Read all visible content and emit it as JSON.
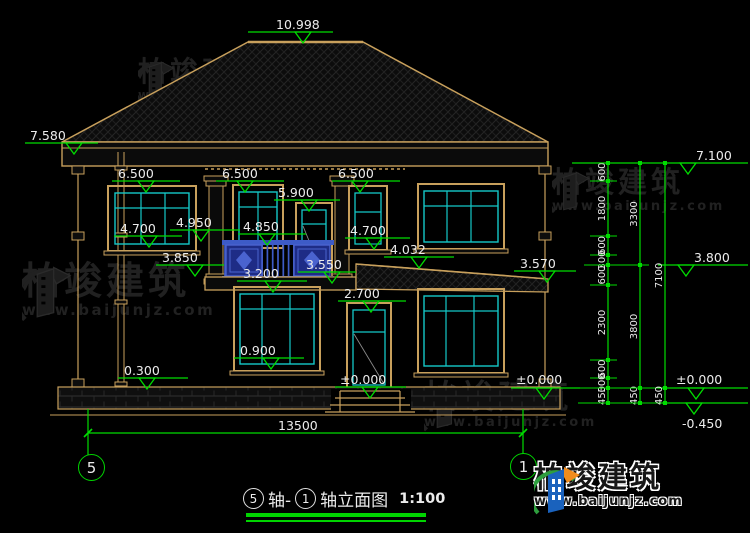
{
  "colors": {
    "tan": "#c8a05c",
    "cyan": "#14c8c8",
    "green": "#00dc00",
    "blue": "#3d5bc7",
    "panel_blue": "#1e2c86",
    "white": "#ececec",
    "watermark": "#212121"
  },
  "title": {
    "axis_start": "5",
    "mid": "轴- ",
    "axis_end": "1",
    "suffix": "轴立面图",
    "scale": "1:100"
  },
  "grid_bubbles": [
    {
      "label": "5"
    },
    {
      "label": "1"
    }
  ],
  "bottom_dim": {
    "label": "13500"
  },
  "levels": [
    {
      "label": "10.998",
      "tx": 276,
      "ty": 29,
      "x1": 248,
      "x2": 333,
      "ly": 32,
      "tri": 303
    },
    {
      "label": "7.580",
      "tx": 30,
      "ty": 140,
      "x1": 25,
      "x2": 98,
      "ly": 143,
      "tri": 74
    },
    {
      "label": "6.500",
      "tx": 118,
      "ty": 178,
      "x1": 112,
      "x2": 180,
      "ly": 181,
      "tri": 146
    },
    {
      "label": "6.500",
      "tx": 222,
      "ty": 178,
      "x1": 216,
      "x2": 284,
      "ly": 181,
      "tri": 245
    },
    {
      "label": "6.500",
      "tx": 338,
      "ty": 178,
      "x1": 332,
      "x2": 400,
      "ly": 181,
      "tri": 360
    },
    {
      "label": "5.900",
      "tx": 278,
      "ty": 197,
      "x1": 274,
      "x2": 340,
      "ly": 200,
      "tri": 309
    },
    {
      "label": "4.950",
      "tx": 176,
      "ty": 227,
      "x1": 170,
      "x2": 240,
      "ly": 230,
      "tri": 201
    },
    {
      "label": "4.700",
      "tx": 120,
      "ty": 233,
      "x1": 114,
      "x2": 182,
      "ly": 236,
      "tri": 149
    },
    {
      "label": "4.850",
      "tx": 243,
      "ty": 231,
      "x1": 238,
      "x2": 306,
      "ly": 234,
      "tri": 267
    },
    {
      "label": "4.700",
      "tx": 350,
      "ty": 235,
      "x1": 345,
      "x2": 410,
      "ly": 238,
      "tri": 374
    },
    {
      "label": "3.850",
      "tx": 162,
      "ty": 262,
      "x1": 156,
      "x2": 224,
      "ly": 265,
      "tri": 195
    },
    {
      "label": "3.200",
      "tx": 243,
      "ty": 278,
      "x1": 237,
      "x2": 307,
      "ly": 281,
      "tri": 273
    },
    {
      "label": "3.550",
      "tx": 306,
      "ty": 269,
      "x1": 298,
      "x2": 356,
      "ly": 272,
      "tri": 332
    },
    {
      "label": "4.032",
      "tx": 390,
      "ty": 254,
      "x1": 384,
      "x2": 454,
      "ly": 257,
      "tri": 419
    },
    {
      "label": "3.570",
      "tx": 520,
      "ty": 268,
      "x1": 514,
      "x2": 576,
      "ly": 271,
      "tri": 547
    },
    {
      "label": "2.700",
      "tx": 344,
      "ty": 298,
      "x1": 338,
      "x2": 406,
      "ly": 301,
      "tri": 371
    },
    {
      "label": "0.900",
      "tx": 240,
      "ty": 355,
      "x1": 234,
      "x2": 304,
      "ly": 358,
      "tri": 271
    },
    {
      "label": "0.300",
      "tx": 124,
      "ty": 375,
      "x1": 118,
      "x2": 188,
      "ly": 378,
      "tri": 147
    },
    {
      "label": "±0.000",
      "tx": 340,
      "ty": 384,
      "x1": 335,
      "x2": 406,
      "ly": 387,
      "tri": 370
    },
    {
      "label": "±0.000",
      "tx": 516,
      "ty": 384,
      "x1": 511,
      "x2": 580,
      "ly": 388,
      "tri": 544
    },
    {
      "label": "7.100",
      "tx": 696,
      "ty": 160,
      "x1": 572,
      "x2": 748,
      "ly": 163,
      "tri": 688
    },
    {
      "label": "3.800",
      "tx": 694,
      "ty": 262,
      "x1": 658,
      "x2": 748,
      "ly": 265,
      "tri": 686
    },
    {
      "label": "±0.000",
      "tx": 676,
      "ty": 384,
      "x1": 658,
      "x2": 748,
      "ly": 388,
      "tri": 696
    },
    {
      "label": "-0.450",
      "tx": 682,
      "ty": 428,
      "x1": 658,
      "x2": 748,
      "ly": 403,
      "tri": 694
    }
  ],
  "chains": [
    {
      "x": 608,
      "tx1": 590,
      "segs": [
        {
          "v": "600",
          "y1": 163,
          "y2": 181
        },
        {
          "v": "1800",
          "y1": 181,
          "y2": 236
        },
        {
          "v": "600",
          "y1": 236,
          "y2": 255
        },
        {
          "v": "300",
          "y1": 255,
          "y2": 265
        },
        {
          "v": "600",
          "y1": 265,
          "y2": 285
        },
        {
          "v": "2300",
          "y1": 285,
          "y2": 360
        },
        {
          "v": "600",
          "y1": 360,
          "y2": 378
        },
        {
          "v": "300",
          "y1": 378,
          "y2": 388
        },
        {
          "v": "450",
          "y1": 388,
          "y2": 403
        }
      ]
    },
    {
      "x": 640,
      "tx1": 584,
      "segs": [
        {
          "v": "3300",
          "y1": 163,
          "y2": 265
        },
        {
          "v": "3800",
          "y1": 265,
          "y2": 388
        },
        {
          "v": "450",
          "y1": 388,
          "y2": 403
        }
      ]
    },
    {
      "x": 665,
      "tx1": 578,
      "segs": [
        {
          "v": "7100",
          "y1": 163,
          "y2": 388
        },
        {
          "v": "450",
          "y1": 388,
          "y2": 403
        }
      ]
    }
  ],
  "watermarks": [
    {
      "text": "柏竣建筑",
      "url": "www.baijunjz.com",
      "x": 138,
      "y": 58,
      "s1": 28,
      "s2": 12
    },
    {
      "text": "柏竣建筑",
      "url": "www.baijunjz.com",
      "x": 552,
      "y": 168,
      "s1": 29,
      "s2": 13
    },
    {
      "text": "柏竣建筑",
      "url": "www.baijunjz.com",
      "x": 22,
      "y": 262,
      "s1": 38,
      "s2": 15
    },
    {
      "text": "柏竣建筑",
      "url": "www.baijunjz.com",
      "x": 424,
      "y": 380,
      "s1": 33,
      "s2": 13
    }
  ],
  "logo": {
    "name": "柏竣建筑",
    "url": "www.baijunjz.com"
  }
}
